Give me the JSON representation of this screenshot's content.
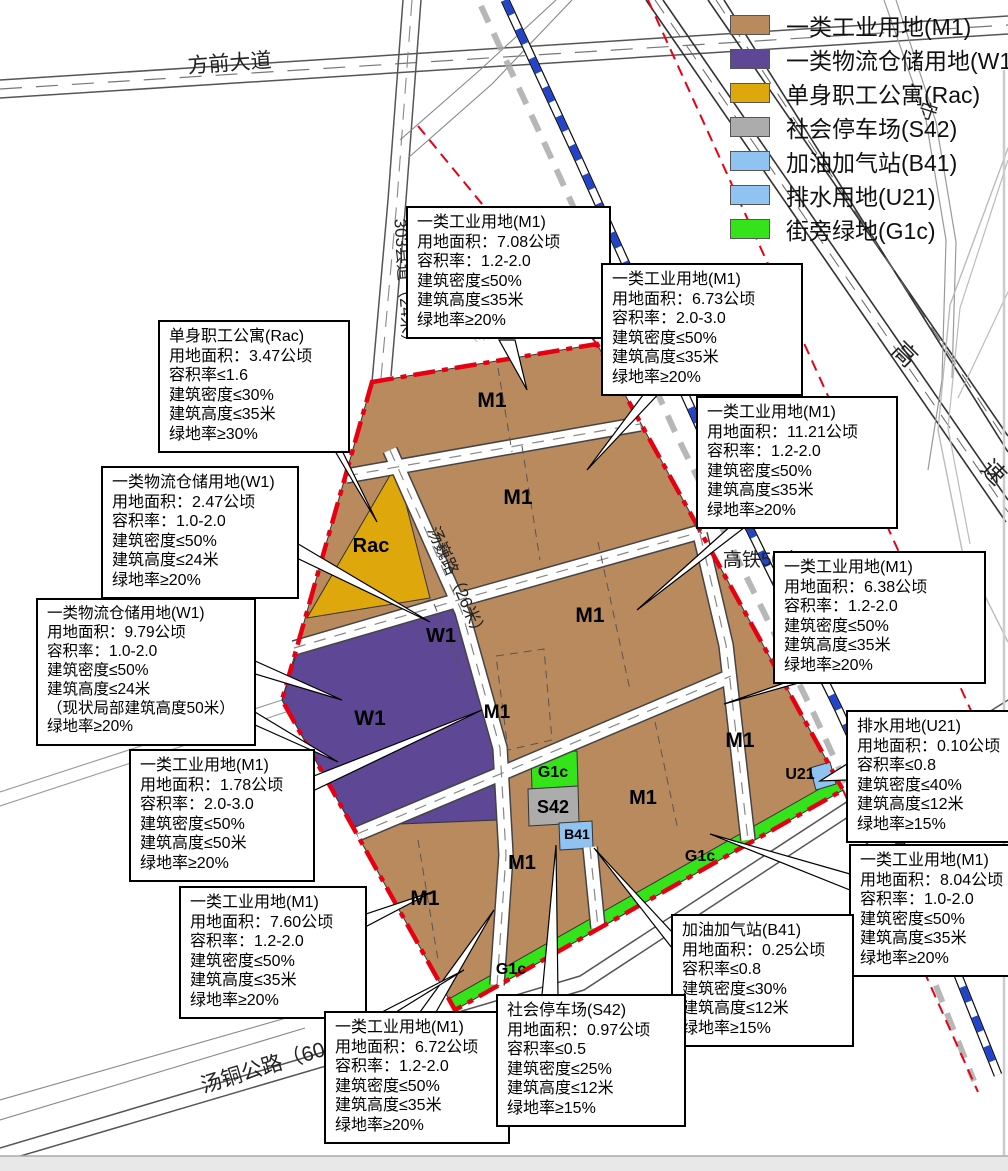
{
  "colors": {
    "m1": "#BA8A5F",
    "w1": "#5E4794",
    "rac": "#DEA70B",
    "s42": "#ACACAC",
    "b41": "#8FC3F2",
    "u21": "#8FC3F2",
    "g1c": "#35E31A",
    "boundary_red": "#E60012",
    "rail_blue": "#2244CC"
  },
  "legend": {
    "items": [
      {
        "label": "一类工业用地(M1)",
        "color": "#BA8A5F"
      },
      {
        "label": "一类物流仓储用地(W1)",
        "color": "#5E4794"
      },
      {
        "label": "单身职工公寓(Rac)",
        "color": "#DEA70B"
      },
      {
        "label": "社会停车场(S42)",
        "color": "#ACACAC"
      },
      {
        "label": "加油加气站(B41)",
        "color": "#8FC3F2"
      },
      {
        "label": "排水用地(U21)",
        "color": "#8FC3F2"
      },
      {
        "label": "街旁绿地(G1c)",
        "color": "#35E31A"
      }
    ]
  },
  "map": {
    "codes": {
      "m1": "M1",
      "w1": "W1",
      "rac": "Rac",
      "g1c": "G1c",
      "s42": "S42",
      "b41": "B41",
      "u21": "U21"
    },
    "road_labels": {
      "fangqian": "方前大道",
      "xiandao": "303县道（24米）",
      "tangwei": "汤巍路（26米）",
      "tangtong": "汤铜公路（60米）",
      "gaotie": "高铁50米",
      "gaosu": [
        "高",
        "速"
      ],
      "shou": "守",
      "xianzhuang": "（现状）"
    }
  },
  "callouts": [
    {
      "id": "m1-708",
      "lines": [
        "一类工业用地(M1)",
        "用地面积：7.08公顷",
        "容积率：1.2-2.0",
        "建筑密度≤50%",
        "建筑高度≤35米",
        "绿地率≥20%"
      ]
    },
    {
      "id": "m1-673",
      "lines": [
        "一类工业用地(M1)",
        "用地面积：6.73公顷",
        "容积率：2.0-3.0",
        "建筑密度≤50%",
        "建筑高度≤35米",
        "绿地率≥20%"
      ]
    },
    {
      "id": "rac-347",
      "lines": [
        "单身职工公寓(Rac)",
        "用地面积：3.47公顷",
        "容积率≤1.6",
        "建筑密度≤30%",
        "建筑高度≤35米",
        "绿地率≥30%"
      ]
    },
    {
      "id": "m1-1121",
      "lines": [
        "一类工业用地(M1)",
        "用地面积：11.21公顷",
        "容积率：1.2-2.0",
        "建筑密度≤50%",
        "建筑高度≤35米",
        "绿地率≥20%"
      ]
    },
    {
      "id": "w1-247",
      "lines": [
        "一类物流仓储用地(W1)",
        "用地面积：2.47公顷",
        "容积率：1.0-2.0",
        "建筑密度≤50%",
        "建筑高度≤24米",
        "绿地率≥20%"
      ]
    },
    {
      "id": "m1-638",
      "lines": [
        "一类工业用地(M1)",
        "用地面积：6.38公顷",
        "容积率：1.2-2.0",
        "建筑密度≤50%",
        "建筑高度≤35米",
        "绿地率≥20%"
      ]
    },
    {
      "id": "w1-979",
      "lines": [
        "一类物流仓储用地(W1)",
        "用地面积：9.79公顷",
        "容积率：1.0-2.0",
        "建筑密度≤50%",
        "建筑高度≤24米",
        "（现状局部建筑高度50米）",
        "绿地率≥20%"
      ]
    },
    {
      "id": "u21-010",
      "lines": [
        "排水用地(U21)",
        "用地面积：0.10公顷",
        "容积率≤0.8",
        "建筑密度≤40%",
        "建筑高度≤12米",
        "绿地率≥15%"
      ]
    },
    {
      "id": "m1-178",
      "lines": [
        "一类工业用地(M1)",
        "用地面积：1.78公顷",
        "容积率：2.0-3.0",
        "建筑密度≤50%",
        "建筑高度≤50米",
        "绿地率≥20%"
      ]
    },
    {
      "id": "m1-804",
      "lines": [
        "一类工业用地(M1)",
        "用地面积：8.04公顷",
        "容积率：1.0-2.0",
        "建筑密度≤50%",
        "建筑高度≤35米",
        "绿地率≥20%"
      ]
    },
    {
      "id": "m1-760",
      "lines": [
        "一类工业用地(M1)",
        "用地面积：7.60公顷",
        "容积率：1.2-2.0",
        "建筑密度≤50%",
        "建筑高度≤35米",
        "绿地率≥20%"
      ]
    },
    {
      "id": "b41-025",
      "lines": [
        "加油加气站(B41)",
        "用地面积：0.25公顷",
        "容积率≤0.8",
        "建筑密度≤30%",
        "建筑高度≤12米",
        "绿地率≥15%"
      ]
    },
    {
      "id": "m1-672",
      "lines": [
        "一类工业用地(M1)",
        "用地面积：6.72公顷",
        "容积率：1.2-2.0",
        "建筑密度≤50%",
        "建筑高度≤35米",
        "绿地率≥20%"
      ]
    },
    {
      "id": "s42-097",
      "lines": [
        "社会停车场(S42)",
        "用地面积：0.97公顷",
        "容积率≤0.5",
        "建筑密度≤25%",
        "建筑高度≤12米",
        "绿地率≥15%"
      ]
    }
  ]
}
